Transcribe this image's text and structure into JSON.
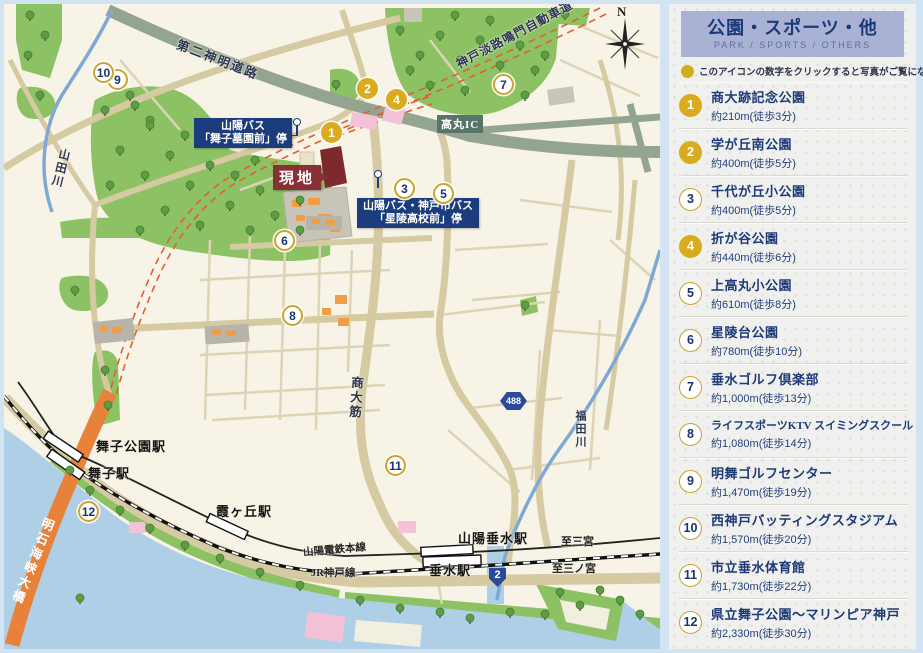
{
  "sidebar": {
    "title": "公園・スポーツ・他",
    "subtitle": "PARK / SPORTS / OTHERS",
    "note": "このアイコンの数字をクリックすると写真がご覧になれます。",
    "legend_icon_color": "#d3ad1b",
    "items": [
      {
        "num": "1",
        "name": "商大跡記念公園",
        "distance": "約210m(徒歩3分)",
        "filled": true
      },
      {
        "num": "2",
        "name": "学が丘南公園",
        "distance": "約400m(徒歩5分)",
        "filled": true
      },
      {
        "num": "3",
        "name": "千代が丘小公園",
        "distance": "約400m(徒歩5分)",
        "filled": false
      },
      {
        "num": "4",
        "name": "折が谷公園",
        "distance": "約440m(徒歩6分)",
        "filled": true
      },
      {
        "num": "5",
        "name": "上高丸小公園",
        "distance": "約610m(徒歩8分)",
        "filled": false
      },
      {
        "num": "6",
        "name": "星陵台公園",
        "distance": "約780m(徒歩10分)",
        "filled": false
      },
      {
        "num": "7",
        "name": "垂水ゴルフ倶楽部",
        "distance": "約1,000m(徒歩13分)",
        "filled": false
      },
      {
        "num": "8",
        "name": "ライフスポーツKTV スイミングスクール",
        "distance": "約1,080m(徒歩14分)",
        "filled": false,
        "long": true
      },
      {
        "num": "9",
        "name": "明舞ゴルフセンター",
        "distance": "約1,470m(徒歩19分)",
        "filled": false
      },
      {
        "num": "10",
        "name": "西神戸バッティングスタジアム",
        "distance": "約1,570m(徒歩20分)",
        "filled": false
      },
      {
        "num": "11",
        "name": "市立垂水体育館",
        "distance": "約1,730m(徒歩22分)",
        "filled": false
      },
      {
        "num": "12",
        "name": "県立舞子公園〜マリンピア神戸",
        "distance": "約2,330m(徒歩30分)",
        "filled": false
      }
    ]
  },
  "map": {
    "labels": {
      "route_daini": "第二神明道路",
      "route_awaji": "神戸淡路鳴門自動車道",
      "bridge": "明石海峡大橋",
      "river_yamada": "山田川",
      "river_fukuda": "福田川",
      "road_shodai": "商大筋",
      "interchange": "高丸IC",
      "site": "現地",
      "bus1_line1": "山陽バス",
      "bus1_line2": "「舞子墓園前」停",
      "bus2_line1": "山陽バス・神戸市バス",
      "bus2_line2": "「星陵高校前」停",
      "st_maiko_koen": "舞子公園駅",
      "st_maiko": "舞子駅",
      "st_kasumigaoka": "霞ヶ丘駅",
      "st_sanyo_tarumi": "山陽垂水駅",
      "st_tarumi": "垂水駅",
      "line_sanyo": "山陽電鉄本線",
      "line_jr": "JR神戸線",
      "to_sannomiya_upper": "至三宮",
      "to_sannomiya_lower": "至三ノ宮",
      "compass_n": "N",
      "badge_488": "488",
      "badge_2": "2"
    },
    "markers": [
      {
        "num": "1",
        "x": 331,
        "y": 132,
        "filled": true
      },
      {
        "num": "2",
        "x": 367,
        "y": 88,
        "filled": true
      },
      {
        "num": "3",
        "x": 404,
        "y": 188,
        "filled": false
      },
      {
        "num": "4",
        "x": 396,
        "y": 99,
        "filled": true
      },
      {
        "num": "5",
        "x": 443,
        "y": 193,
        "filled": false
      },
      {
        "num": "6",
        "x": 284,
        "y": 240,
        "filled": false
      },
      {
        "num": "7",
        "x": 503,
        "y": 84,
        "filled": false
      },
      {
        "num": "8",
        "x": 292,
        "y": 315,
        "filled": false
      },
      {
        "num": "9",
        "x": 117,
        "y": 79,
        "filled": false
      },
      {
        "num": "10",
        "x": 103,
        "y": 72,
        "filled": false
      },
      {
        "num": "11",
        "x": 395,
        "y": 465,
        "filled": false
      },
      {
        "num": "12",
        "x": 88,
        "y": 511,
        "filled": false
      }
    ],
    "colors": {
      "sea": "#aecfe6",
      "land": "#f7f3e6",
      "park_green": "#8cc264",
      "road_tan": "#d5caa2",
      "highway_sage": "#94a58f",
      "bridge_orange": "#e8823a",
      "expressway_dash": "#e2602c",
      "label_navy": "#1b3c7d",
      "site_red": "#8a2f35",
      "marker_gold": "#d9ab1e"
    }
  }
}
